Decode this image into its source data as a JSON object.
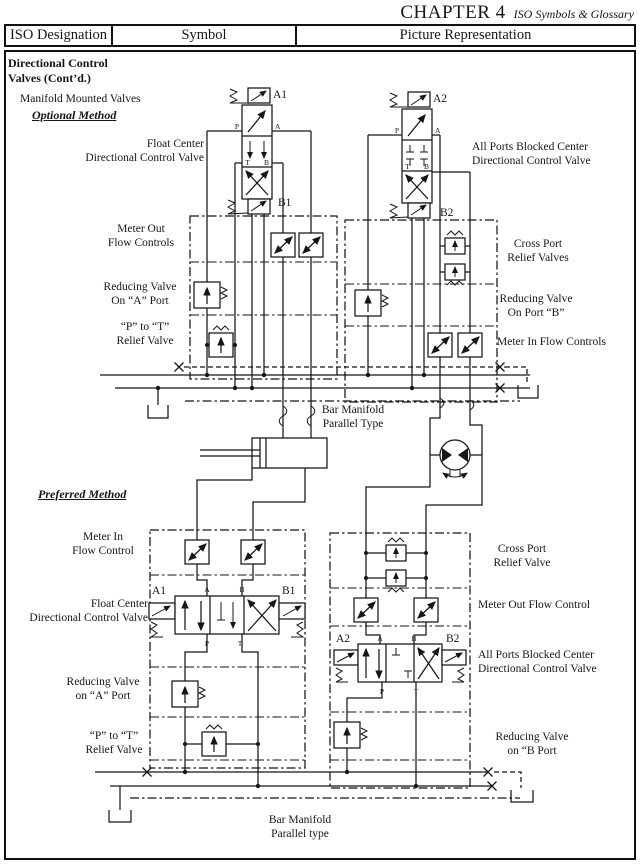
{
  "header": {
    "chapter": "CHAPTER 4",
    "subtitle": "ISO Symbols & Glossary"
  },
  "table": {
    "col1": "ISO Designation",
    "col2": "Symbol",
    "col3": "Picture Representation"
  },
  "sections": {
    "category": "Directional Control\nValves (Cont’d.)",
    "group_intro": "Manifold Mounted Valves",
    "optional_method": "Optional Method",
    "preferred_method": "Preferred Method"
  },
  "optional_labels": {
    "float_center_dcv": "Float Center\nDirectional Control Valve",
    "all_ports_blocked_dcv": "All Ports Blocked Center\nDirectional Control Valve",
    "meter_out_flow_controls": "Meter Out\nFlow Controls",
    "cross_port_relief_valves": "Cross Port\nRelief Valves",
    "reducing_valve_a": "Reducing Valve\nOn “A” Port",
    "reducing_valve_b": "Reducing Valve\nOn Port “B”",
    "p_to_t_relief": "“P” to “T”\nRelief Valve",
    "meter_in_flow_controls": "Meter In Flow Controls",
    "bar_manifold": "Bar Manifold\nParallel Type"
  },
  "preferred_labels": {
    "meter_in_flow_control": "Meter In\nFlow Control",
    "float_center_dcv": "Float Center\nDirectional Control Valve",
    "reducing_valve_a": "Reducing Valve\non “A” Port",
    "p_to_t_relief": "“P” to “T”\nRelief Valve",
    "cross_port_relief_valve": "Cross Port\nRelief Valve",
    "meter_out_flow_control": "Meter Out Flow Control",
    "all_ports_blocked_dcv": "All Ports Blocked Center\nDirectional Control Valve",
    "reducing_valve_b": "Reducing Valve\non “B Port",
    "bar_manifold": "Bar Manifold\nParallel type"
  },
  "valve_tags": {
    "a1": "A1",
    "b1": "B1",
    "a2": "A2",
    "b2": "B2"
  },
  "ports": {
    "p": "P",
    "a": "A",
    "t": "T",
    "b": "B"
  }
}
